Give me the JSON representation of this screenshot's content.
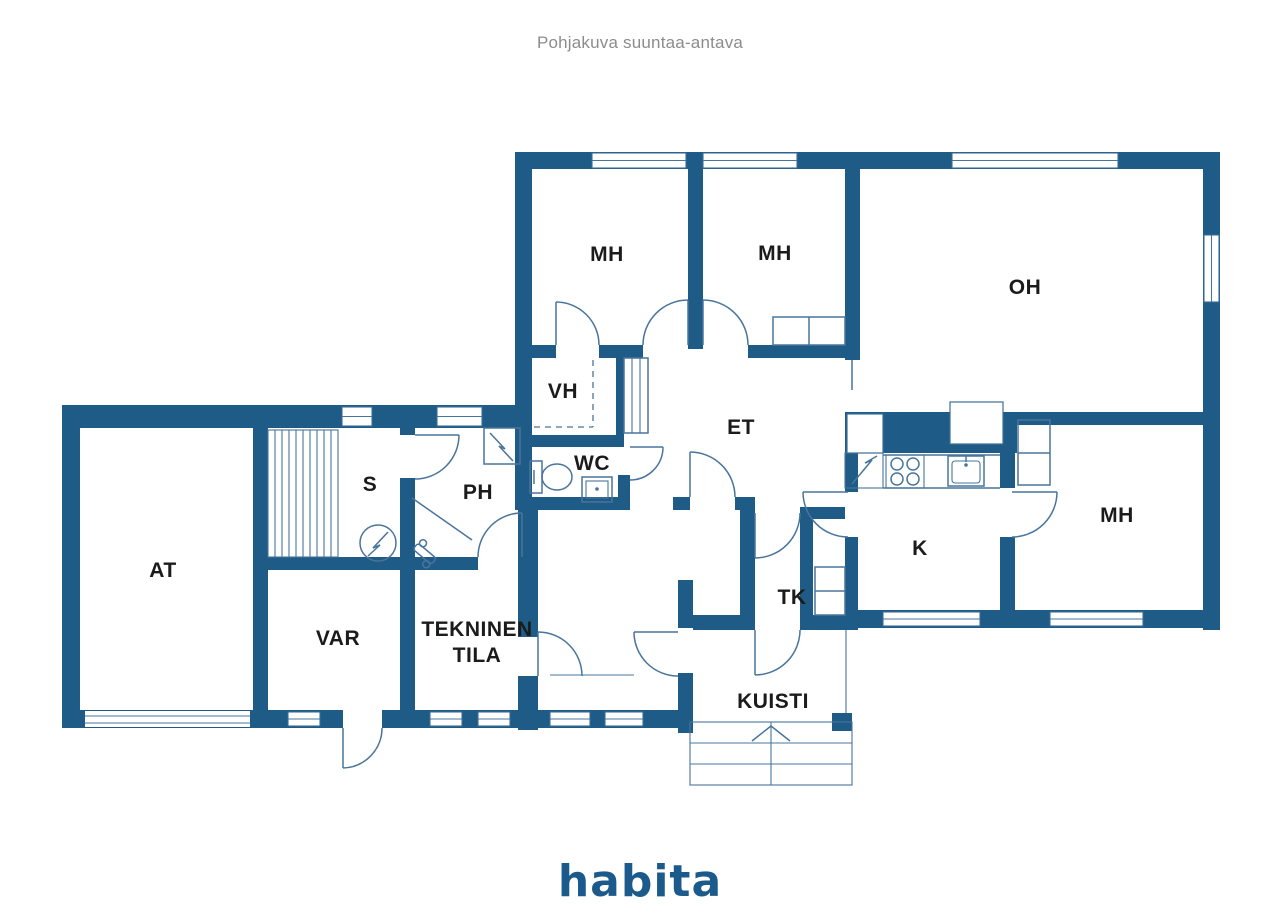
{
  "page": {
    "title": "Pohjakuva suuntaa-antava",
    "brand_logo": "habita"
  },
  "floorplan": {
    "colors": {
      "wall": "#1e5b87",
      "fixture_line": "#49759c",
      "label": "#1b1b1b",
      "title_gray": "#8c8c8c",
      "brand_blue": "#1d5a8c"
    },
    "rooms": [
      {
        "id": "mh-1",
        "label": "MH"
      },
      {
        "id": "mh-2",
        "label": "MH"
      },
      {
        "id": "oh",
        "label": "OH"
      },
      {
        "id": "vh",
        "label": "VH"
      },
      {
        "id": "et",
        "label": "ET"
      },
      {
        "id": "wc",
        "label": "WC"
      },
      {
        "id": "s",
        "label": "S"
      },
      {
        "id": "ph",
        "label": "PH"
      },
      {
        "id": "at",
        "label": "AT"
      },
      {
        "id": "var",
        "label": "VAR"
      },
      {
        "id": "tekninen-tila",
        "label": "TEKNINEN TILA",
        "line1": "TEKNINEN",
        "line2": "TILA"
      },
      {
        "id": "tk",
        "label": "TK"
      },
      {
        "id": "k",
        "label": "K"
      },
      {
        "id": "mh-3",
        "label": "MH"
      },
      {
        "id": "kuisti",
        "label": "KUISTI"
      }
    ]
  }
}
